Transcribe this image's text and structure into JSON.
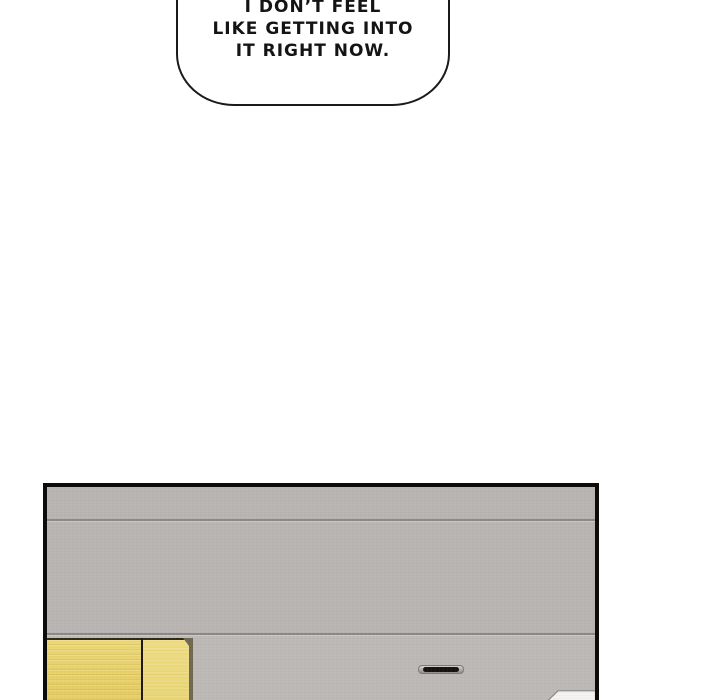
{
  "comic": {
    "speech_bubble": {
      "lines": [
        "I DON’T FEEL",
        "LIKE GETTING INTO",
        "IT RIGHT NOW."
      ],
      "fill_color": "#ffffff",
      "stroke_color": "#1a1a1a",
      "text_color": "#141414"
    },
    "panel": {
      "border_color": "#0d0c0a",
      "wall_color": "#b9b5b3",
      "wall_lower_color": "#bdb9b7",
      "seam_color": "#8b8785",
      "cabinet_yellow": "#e8d26c",
      "cabinet_yellow_light": "#eedc80",
      "cabinet_shadow": "#6e6850",
      "cabinet_outline": "#2e2a18",
      "handle_slot_color": "#151413",
      "paper_color": "#f4f3f1"
    }
  }
}
